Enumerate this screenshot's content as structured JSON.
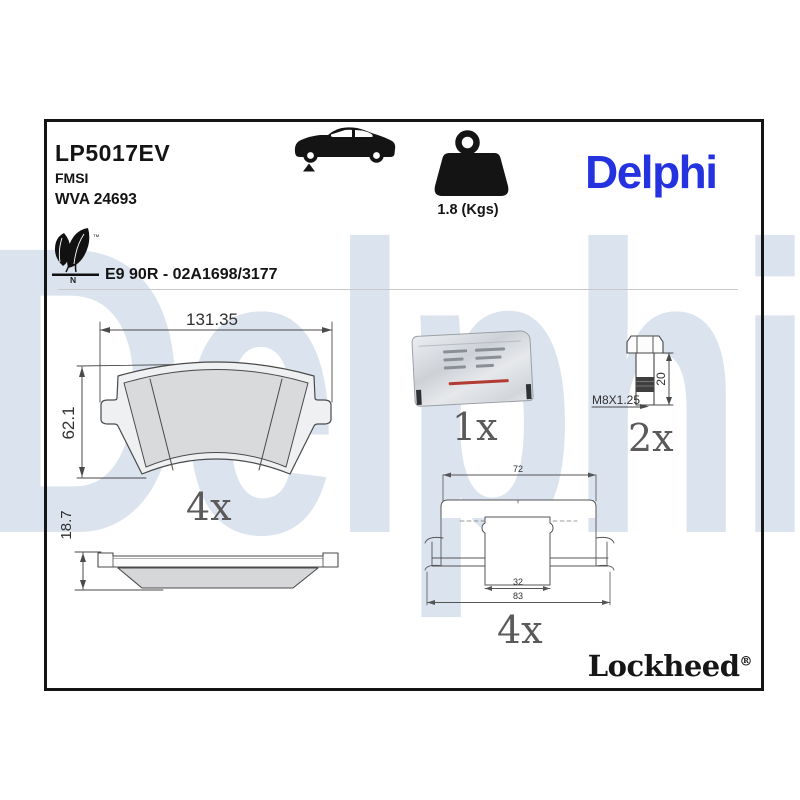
{
  "header": {
    "part_number": "LP5017EV",
    "fmsi_label": "FMSI",
    "wva_number": "WVA 24693",
    "weight": "1.8 (Kgs)",
    "brand": "Delphi",
    "approval": "E9 90R - 02A1698/3177",
    "eco_mark": {
      "tm": "™",
      "n": "N"
    }
  },
  "diagrams": {
    "pad_front": {
      "width_dim": "131.35",
      "height_dim": "62.1",
      "quantity": "4x"
    },
    "pad_side": {
      "thickness_dim": "18.7"
    },
    "grease_sachet": {
      "quantity": "1x"
    },
    "bolt": {
      "thread_spec": "M8X1.25",
      "length_dim": "20",
      "quantity": "2x"
    },
    "fitting_clip": {
      "outer_dim": "72",
      "inner_dim": "32",
      "total_dim": "83",
      "quantity": "4x"
    }
  },
  "footer": {
    "sub_brand": "Lockheed",
    "registered": "®"
  },
  "watermark": "Delphi",
  "colors": {
    "brand_blue": "#2433df",
    "watermark_blue": "#dbe3ee",
    "drawing_line": "#4a4a4a",
    "label_gray": "#5a5a5a"
  }
}
